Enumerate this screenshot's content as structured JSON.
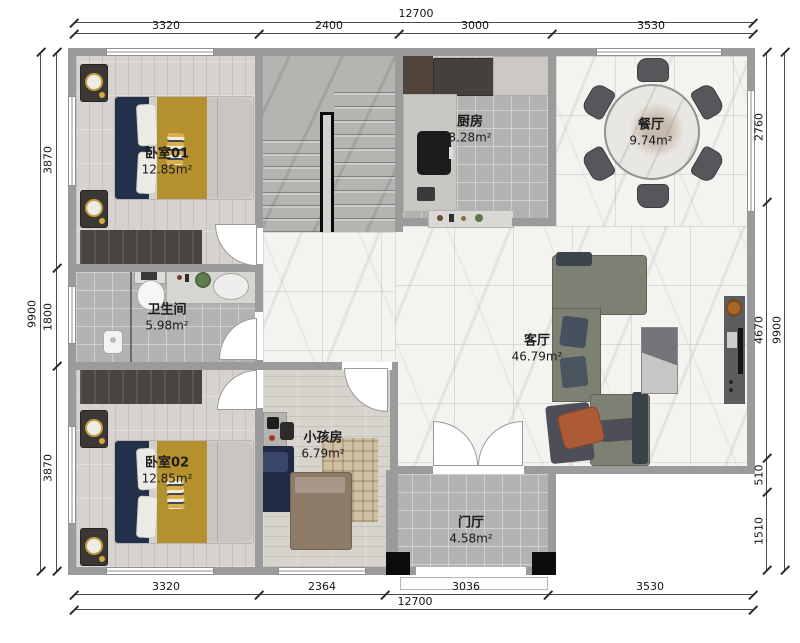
{
  "dims": {
    "top": {
      "total": "12700",
      "segments": [
        "3320",
        "2400",
        "3000",
        "3530"
      ]
    },
    "bottom": {
      "total": "12700",
      "segments": [
        "3320",
        "2364",
        "3036",
        "3530"
      ]
    },
    "left": {
      "total": "9900",
      "segments": [
        "3870",
        "1800",
        "3870"
      ]
    },
    "right": {
      "total": "9900",
      "segments": [
        "2760",
        "4670",
        "510",
        "1510"
      ]
    }
  },
  "rooms": {
    "bedroom1": {
      "name": "卧室01",
      "area": "12.85m²"
    },
    "kitchen": {
      "name": "厨房",
      "area": "8.28m²"
    },
    "dining": {
      "name": "餐厅",
      "area": "9.74m²"
    },
    "bathroom": {
      "name": "卫生间",
      "area": "5.98m²"
    },
    "living": {
      "name": "客厅",
      "area": "46.79m²"
    },
    "bedroom2": {
      "name": "卧室02",
      "area": "12.85m²"
    },
    "kids": {
      "name": "小孩房",
      "area": "6.79m²"
    },
    "foyer": {
      "name": "门厅",
      "area": "4.58m²"
    }
  },
  "colors": {
    "wall": "#9b9b9b",
    "wood_floor": "#d6d3cf",
    "tile_floor": "#b3b2b0",
    "marble_floor": "#f4f3f0",
    "stairs": "#b6b4b1",
    "wardrobe": "#474442",
    "sofa": "#7c8173",
    "bed_navy": "#23304a",
    "bed_mustard": "#b5902e",
    "accent_orange": "#ad5b36",
    "pillar": "#0c0c0c"
  }
}
